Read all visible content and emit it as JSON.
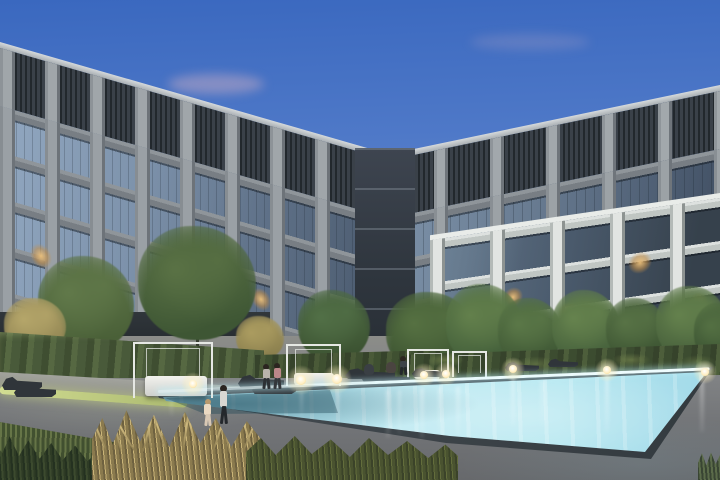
{
  "meta": {
    "type": "architectural-render",
    "time_of_day": "dusk",
    "description": "L-shaped modern apartment complex with gridded concrete-and-glass facade, landscaped courtyard and illuminated swimming pool at dusk",
    "width": 720,
    "height": 480
  },
  "palette": {
    "sky_top": "#3a68bf",
    "sky_horizon": "#c7d6ee",
    "cloud_pink": "#e2b8c4",
    "concrete_light": "#a0a6aa",
    "concrete_shadow": "#6d7379",
    "concrete_white": "#e2e5e2",
    "louver_dark": "#2a3036",
    "glass_reflection": "#92a8c1",
    "glass_dark": "#46556a",
    "window_warm": "#d2a368",
    "hedge_green": "#4a5a38",
    "tree_green": "#47603a",
    "tree_gold": "#a3925a",
    "lawn_green": "#55683a",
    "lit_grass": "#cdd98e",
    "deck_gray": "#7b7d80",
    "pool_bright": "#bfeaf2",
    "pool_mid": "#7fb8cb",
    "pool_deep": "#5d8ea0",
    "waterline": "#e6fafc",
    "coping_dark": "#3c4348",
    "cabana_white": "#e6e8e4",
    "lounger_dark": "#30353a",
    "lamp_glow": "#fff3cf"
  },
  "counts": {
    "building_wings": 2,
    "visible_floors": 7,
    "cabana_frames": 4,
    "lounge_chairs": 9,
    "pool_lights": 8,
    "people": 7,
    "trees": 12
  },
  "labels": {
    "scene": "apartment complex courtyard with pool at dusk",
    "left_wing": "left building wing, gray concrete grid facade with top-floor louvers",
    "right_wing": "right building wing with white concrete frame section",
    "pool": "illuminated turquoise swimming pool",
    "cabana": "white frame cabana with daybed",
    "walking_pair": "adult walking with child beside pool"
  },
  "scene": {
    "clouds": [
      {
        "x": 168,
        "y": 74,
        "w": 96,
        "h": 20,
        "o": 0.4
      },
      {
        "x": 470,
        "y": 34,
        "w": 120,
        "h": 16,
        "o": 0.18
      }
    ],
    "trees": [
      {
        "x": 38,
        "y": 256,
        "w": 96,
        "h": 96,
        "c1": "#4a6038",
        "c2": "#61794a",
        "tr": 350
      },
      {
        "x": 138,
        "y": 226,
        "w": 118,
        "h": 114,
        "c1": "#3e5634",
        "c2": "#5a7245",
        "tr": 352
      },
      {
        "x": 4,
        "y": 298,
        "w": 62,
        "h": 56,
        "c1": "#8f8352",
        "c2": "#b5a66a",
        "tr": 356
      },
      {
        "x": 298,
        "y": 290,
        "w": 72,
        "h": 72,
        "c1": "#3c5332",
        "c2": "#527047",
        "tr": 362
      },
      {
        "x": 236,
        "y": 316,
        "w": 48,
        "h": 44,
        "c1": "#8a7f4e",
        "c2": "#ab9c60",
        "tr": 362
      },
      {
        "x": 386,
        "y": 292,
        "w": 88,
        "h": 82,
        "c1": "#3a5130",
        "c2": "#567142",
        "tr": 372
      },
      {
        "x": 446,
        "y": 284,
        "w": 76,
        "h": 82,
        "c1": "#44603b",
        "c2": "#63804c",
        "tr": 368
      },
      {
        "x": 498,
        "y": 298,
        "w": 64,
        "h": 68,
        "c1": "#3f5835",
        "c2": "#5b7848",
        "tr": 366
      },
      {
        "x": 552,
        "y": 290,
        "w": 68,
        "h": 74,
        "c1": "#46613c",
        "c2": "#66834e",
        "tr": 366
      },
      {
        "x": 606,
        "y": 298,
        "w": 60,
        "h": 64,
        "c1": "#3d5533",
        "c2": "#587346",
        "tr": 364
      },
      {
        "x": 656,
        "y": 286,
        "w": 72,
        "h": 76,
        "c1": "#465f3b",
        "c2": "#64814d",
        "tr": 364
      },
      {
        "x": 694,
        "y": 303,
        "w": 52,
        "h": 60,
        "c1": "#3a5232",
        "c2": "#547043",
        "tr": 364
      }
    ],
    "lit_windows_left": [
      {
        "x": 30,
        "y": 126,
        "w": 22,
        "h": 24
      },
      {
        "x": 74,
        "y": 138,
        "w": 20,
        "h": 24
      },
      {
        "x": 146,
        "y": 138,
        "w": 22,
        "h": 22
      },
      {
        "x": 56,
        "y": 200,
        "w": 20,
        "h": 24
      },
      {
        "x": 108,
        "y": 224,
        "w": 22,
        "h": 22
      },
      {
        "x": 214,
        "y": 155,
        "w": 20,
        "h": 22
      },
      {
        "x": 296,
        "y": 169,
        "w": 20,
        "h": 22
      },
      {
        "x": 176,
        "y": 222,
        "w": 22,
        "h": 22
      },
      {
        "x": 251,
        "y": 107,
        "w": 20,
        "h": 22
      }
    ],
    "lit_windows_right": [
      {
        "x": 50,
        "y": 102,
        "w": 22,
        "h": 24
      },
      {
        "x": 110,
        "y": 95,
        "w": 20,
        "h": 22
      },
      {
        "x": 180,
        "y": 90,
        "w": 22,
        "h": 22
      },
      {
        "x": 260,
        "y": 92,
        "w": 20,
        "h": 22
      },
      {
        "x": 90,
        "y": 160,
        "w": 22,
        "h": 24
      },
      {
        "x": 165,
        "y": 166,
        "w": 20,
        "h": 22
      }
    ],
    "lit_windows_white": [
      {
        "x": 198,
        "y": 42,
        "w": 24,
        "h": 22
      },
      {
        "x": 73,
        "y": 59,
        "w": 20,
        "h": 20
      },
      {
        "x": 128,
        "y": 82,
        "w": 22,
        "h": 20
      },
      {
        "x": 258,
        "y": 91,
        "w": 20,
        "h": 20
      },
      {
        "x": 33,
        "y": 88,
        "w": 18,
        "h": 18
      }
    ],
    "ground_lights": [
      {
        "x": 536,
        "y": 342,
        "w": 22,
        "h": 18
      },
      {
        "x": 586,
        "y": 339,
        "w": 18,
        "h": 20
      },
      {
        "x": 640,
        "y": 342,
        "w": 20,
        "h": 18
      },
      {
        "x": 698,
        "y": 347,
        "w": 16,
        "h": 18
      },
      {
        "x": 468,
        "y": 330,
        "w": 14,
        "h": 14
      },
      {
        "x": 55,
        "y": 334,
        "w": 10,
        "h": 14
      }
    ],
    "cabanas": [
      {
        "x": 133,
        "y": 342,
        "w": 80,
        "h": 56,
        "bed": {
          "x": 10,
          "y": 32,
          "w": 62,
          "h": 20
        }
      },
      {
        "x": 286,
        "y": 344,
        "w": 55,
        "h": 42,
        "bed": {
          "x": 6,
          "y": 27,
          "w": 40,
          "h": 12
        }
      },
      {
        "x": 407,
        "y": 349,
        "w": 42,
        "h": 30,
        "bed": {
          "x": 5,
          "y": 19,
          "w": 26,
          "h": 9
        }
      },
      {
        "x": 452,
        "y": 351,
        "w": 35,
        "h": 26,
        "bed": null
      }
    ],
    "loungers": [
      {
        "x": 2,
        "y": 374,
        "w": 40,
        "h": 16
      },
      {
        "x": 14,
        "y": 382,
        "w": 42,
        "h": 15
      },
      {
        "x": 238,
        "y": 372,
        "w": 46,
        "h": 16
      },
      {
        "x": 252,
        "y": 380,
        "w": 44,
        "h": 14
      },
      {
        "x": 345,
        "y": 366,
        "w": 50,
        "h": 13
      },
      {
        "x": 362,
        "y": 371,
        "w": 48,
        "h": 12
      },
      {
        "x": 412,
        "y": 366,
        "w": 36,
        "h": 11
      },
      {
        "x": 505,
        "y": 360,
        "w": 34,
        "h": 11
      },
      {
        "x": 548,
        "y": 357,
        "w": 30,
        "h": 10
      }
    ],
    "lamps": [
      {
        "x": 193,
        "y": 384,
        "r": 4
      },
      {
        "x": 301,
        "y": 380,
        "r": 5
      },
      {
        "x": 337,
        "y": 379,
        "r": 5
      },
      {
        "x": 424,
        "y": 375,
        "r": 4
      },
      {
        "x": 446,
        "y": 374,
        "r": 4
      },
      {
        "x": 513,
        "y": 369,
        "r": 4
      },
      {
        "x": 607,
        "y": 370,
        "r": 4
      },
      {
        "x": 705,
        "y": 372,
        "r": 4
      }
    ],
    "reflections": [
      {
        "x": 386,
        "y": 390,
        "w": 4,
        "h": 48,
        "o": 0.55
      },
      {
        "x": 398,
        "y": 390,
        "w": 3,
        "h": 44,
        "o": 0.45
      },
      {
        "x": 420,
        "y": 388,
        "w": 4,
        "h": 50,
        "o": 0.55
      },
      {
        "x": 438,
        "y": 388,
        "w": 3,
        "h": 46,
        "o": 0.5
      },
      {
        "x": 456,
        "y": 386,
        "w": 4,
        "h": 50,
        "o": 0.5
      },
      {
        "x": 300,
        "y": 392,
        "w": 3,
        "h": 26,
        "o": 0.35
      },
      {
        "x": 336,
        "y": 391,
        "w": 4,
        "h": 28,
        "o": 0.4
      },
      {
        "x": 511,
        "y": 374,
        "w": 4,
        "h": 52,
        "o": 0.6
      },
      {
        "x": 605,
        "y": 374,
        "w": 4,
        "h": 58,
        "o": 0.6
      },
      {
        "x": 700,
        "y": 376,
        "w": 4,
        "h": 56,
        "o": 0.55
      },
      {
        "x": 170,
        "y": 400,
        "w": 3,
        "h": 16,
        "o": 0.3
      },
      {
        "x": 540,
        "y": 380,
        "w": 6,
        "h": 46,
        "o": 0.35
      }
    ],
    "people": [
      {
        "type": "adult",
        "x": 216,
        "y": 385,
        "h": 42,
        "top": "#d8d7d2",
        "legs": "#24282c",
        "hair": "#2b2520"
      },
      {
        "type": "child",
        "x": 202,
        "y": 399,
        "h": 28,
        "top": "#ead9c2",
        "legs": "#d8c8b4",
        "hair": "#b99a6e"
      },
      {
        "type": "stand",
        "x": 261,
        "y": 364,
        "h": 26,
        "top": "#b9b4ac",
        "legs": "#2c3034",
        "hair": "#2b2520"
      },
      {
        "type": "stand",
        "x": 272,
        "y": 363,
        "h": 27,
        "top": "#bb8789",
        "legs": "#33373b",
        "hair": "#2b2520"
      },
      {
        "type": "sit",
        "x": 364,
        "y": 364,
        "h": 11,
        "top": "#3a3f44"
      },
      {
        "type": "sit",
        "x": 386,
        "y": 362,
        "h": 11,
        "top": "#4a4440"
      },
      {
        "type": "stand",
        "x": 398,
        "y": 356,
        "h": 18,
        "top": "#3d4248",
        "legs": "#24282c",
        "hair": "#2b2520"
      }
    ],
    "gold_blades": [
      {
        "x": 14,
        "r": -24
      },
      {
        "x": 28,
        "r": -12
      },
      {
        "x": 42,
        "r": -30
      },
      {
        "x": 58,
        "r": -6
      },
      {
        "x": 74,
        "r": -20
      },
      {
        "x": 90,
        "r": 8
      },
      {
        "x": 104,
        "r": -14
      },
      {
        "x": 120,
        "r": 18
      },
      {
        "x": 136,
        "r": -8
      },
      {
        "x": 150,
        "r": 22
      },
      {
        "x": 160,
        "r": -18
      },
      {
        "x": 50,
        "r": 14
      }
    ]
  }
}
